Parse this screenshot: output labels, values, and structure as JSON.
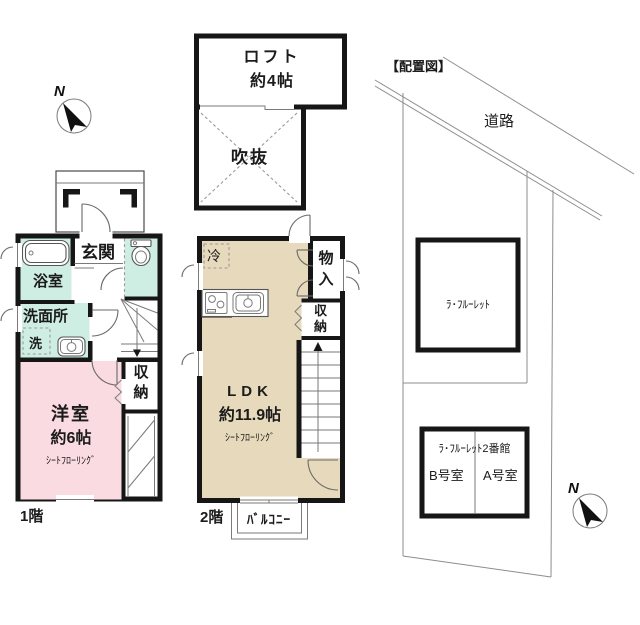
{
  "colors": {
    "wall": "#161616",
    "room_pink": "#fbdbe2",
    "room_mint": "#cfeee3",
    "room_beige": "#e7dabc",
    "line_gray": "#8d8d8d"
  },
  "compass": {
    "label": "N"
  },
  "loft": {
    "name": "ロフト",
    "size": "約4帖",
    "void_label": "吹抜"
  },
  "floor1": {
    "label": "1階",
    "entrance": "玄関",
    "bathroom": "浴室",
    "washroom": "洗面所",
    "washer": "洗",
    "western_room": "洋室",
    "western_room_size": "約6帖",
    "flooring": "ｼｰﾄﾌﾛｰﾘﾝｸﾞ",
    "storage": "収納"
  },
  "floor2": {
    "label": "2階",
    "ldk": "LDK",
    "ldk_size": "約11.9帖",
    "flooring": "ｼｰﾄﾌﾛｰﾘﾝｸﾞ",
    "fridge": "冷",
    "closet": "物入",
    "storage": "収納",
    "balcony": "ﾊﾞﾙｺﾆｰ"
  },
  "site_plan": {
    "title": "【配置図】",
    "road": "道路",
    "building1": "ﾗ･ﾌﾙｰﾚｯﾄ",
    "building2": "ﾗ･ﾌﾙｰﾚｯﾄ2番館",
    "room_b": "B号室",
    "room_a": "A号室"
  }
}
